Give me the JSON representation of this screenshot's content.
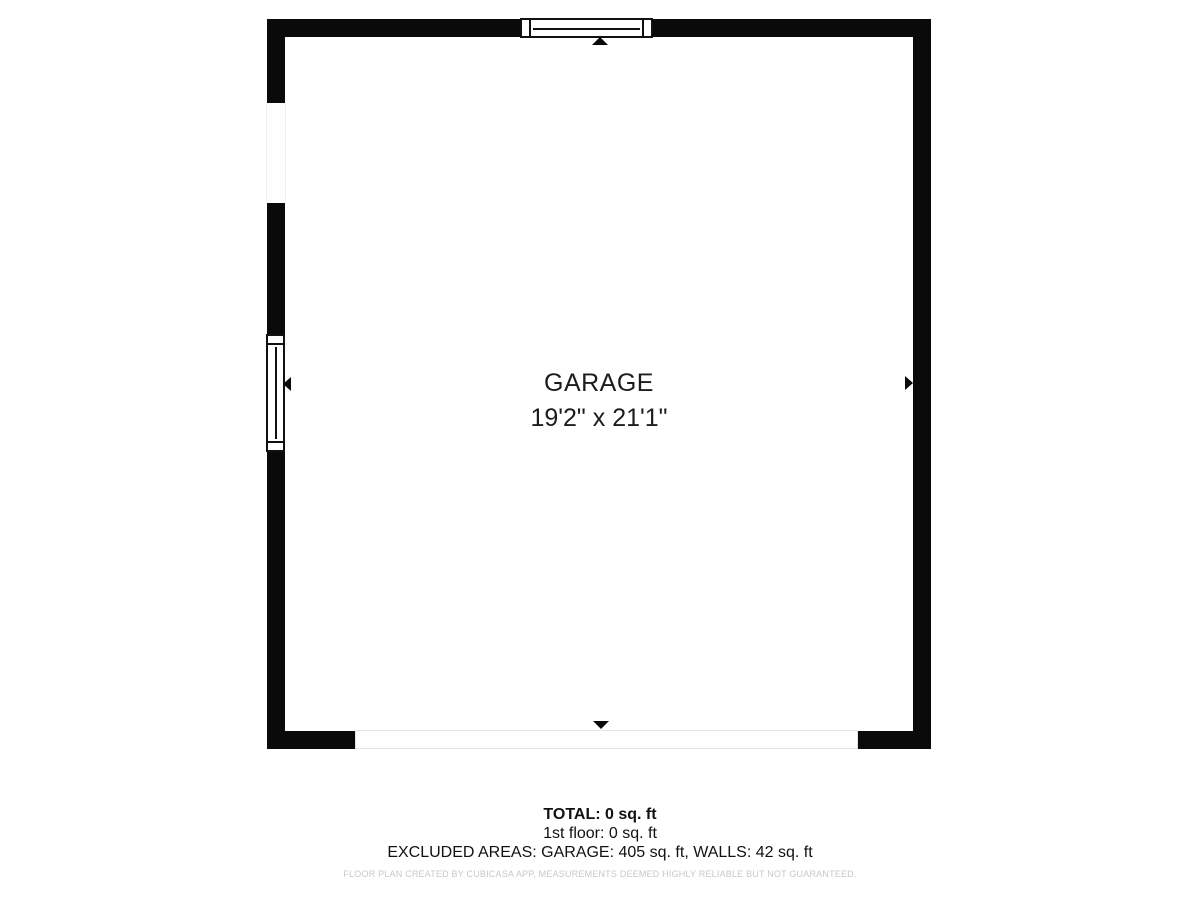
{
  "floor_plan": {
    "room": {
      "name": "GARAGE",
      "dimensions": "19'2\" x 21'1\""
    },
    "summary": {
      "total": "TOTAL: 0 sq. ft",
      "first_floor": "1st floor: 0 sq. ft",
      "excluded_areas": "EXCLUDED AREAS: GARAGE: 405 sq. ft, WALLS: 42 sq. ft"
    },
    "disclaimer": "FLOOR PLAN CREATED BY CUBICASA APP, MEASUREMENTS DEEMED HIGHLY RELIABLE BUT NOT GUARANTEED.",
    "features": {
      "windows": [
        "top-wall-window",
        "left-wall-window"
      ],
      "openings": [
        "left-wall-opening",
        "bottom-garage-door-opening"
      ],
      "arrows": [
        "up",
        "down",
        "left",
        "right"
      ]
    },
    "colors": {
      "wall": "#0a0a0a",
      "background": "#ffffff",
      "label_text": "#1c1c1c",
      "summary_text": "#111111",
      "disclaimer_text": "#c8c8c8",
      "door_outline": "#e4e4e4"
    }
  }
}
